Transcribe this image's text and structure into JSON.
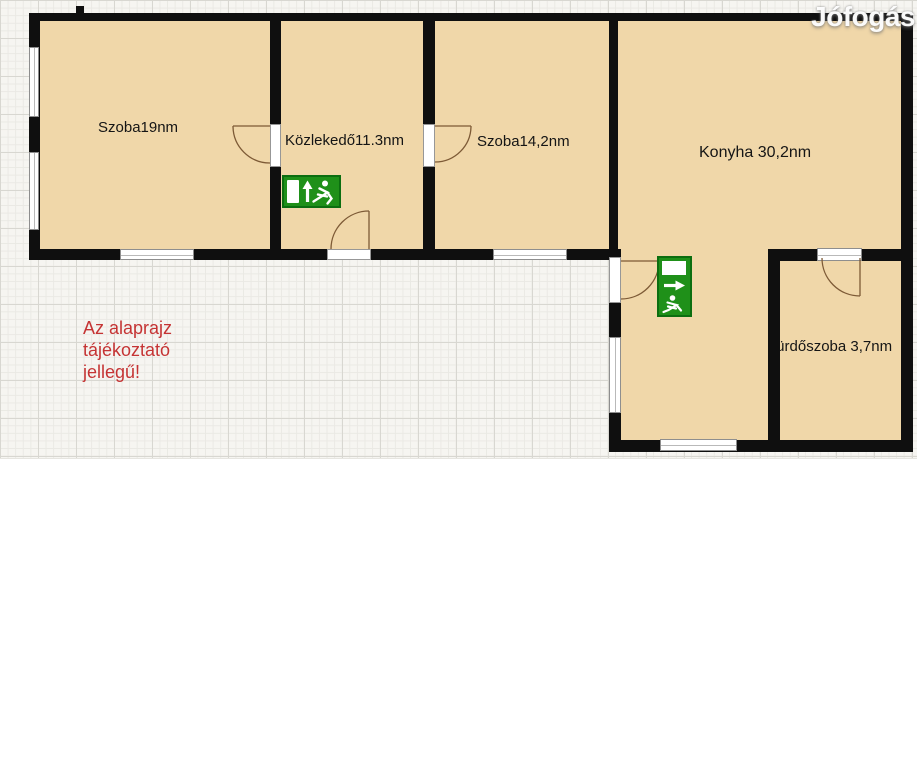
{
  "watermark": {
    "text": "Jófogás"
  },
  "note": {
    "line1": "Az alaprajz",
    "line2": "tájékoztató",
    "line3": "jellegű!"
  },
  "rooms": {
    "szoba19": {
      "label": "Szoba19nm",
      "area_sqm": 19
    },
    "kozlekedo": {
      "label": "Közlekedő11.3nm",
      "area_sqm": 11.3
    },
    "szoba14": {
      "label": "Szoba14,2nm",
      "area_sqm": 14.2
    },
    "konyha": {
      "label": "Konyha 30,2nm",
      "area_sqm": 30.2
    },
    "furdoszoba": {
      "label": "fürdőszoba 3,7nm",
      "area_sqm": 3.7
    }
  },
  "icons": {
    "exit_sign_horizontal": "emergency-exit-door-up-arrow-running-man",
    "exit_sign_vertical": "emergency-exit-door-right-arrow-running-man"
  },
  "colors": {
    "room_fill": "#f0d7a9",
    "wall": "#0f0f0f",
    "exit_green": "#1f9019",
    "note_red": "#c53434",
    "grid_bg": "#f6f5f1"
  }
}
